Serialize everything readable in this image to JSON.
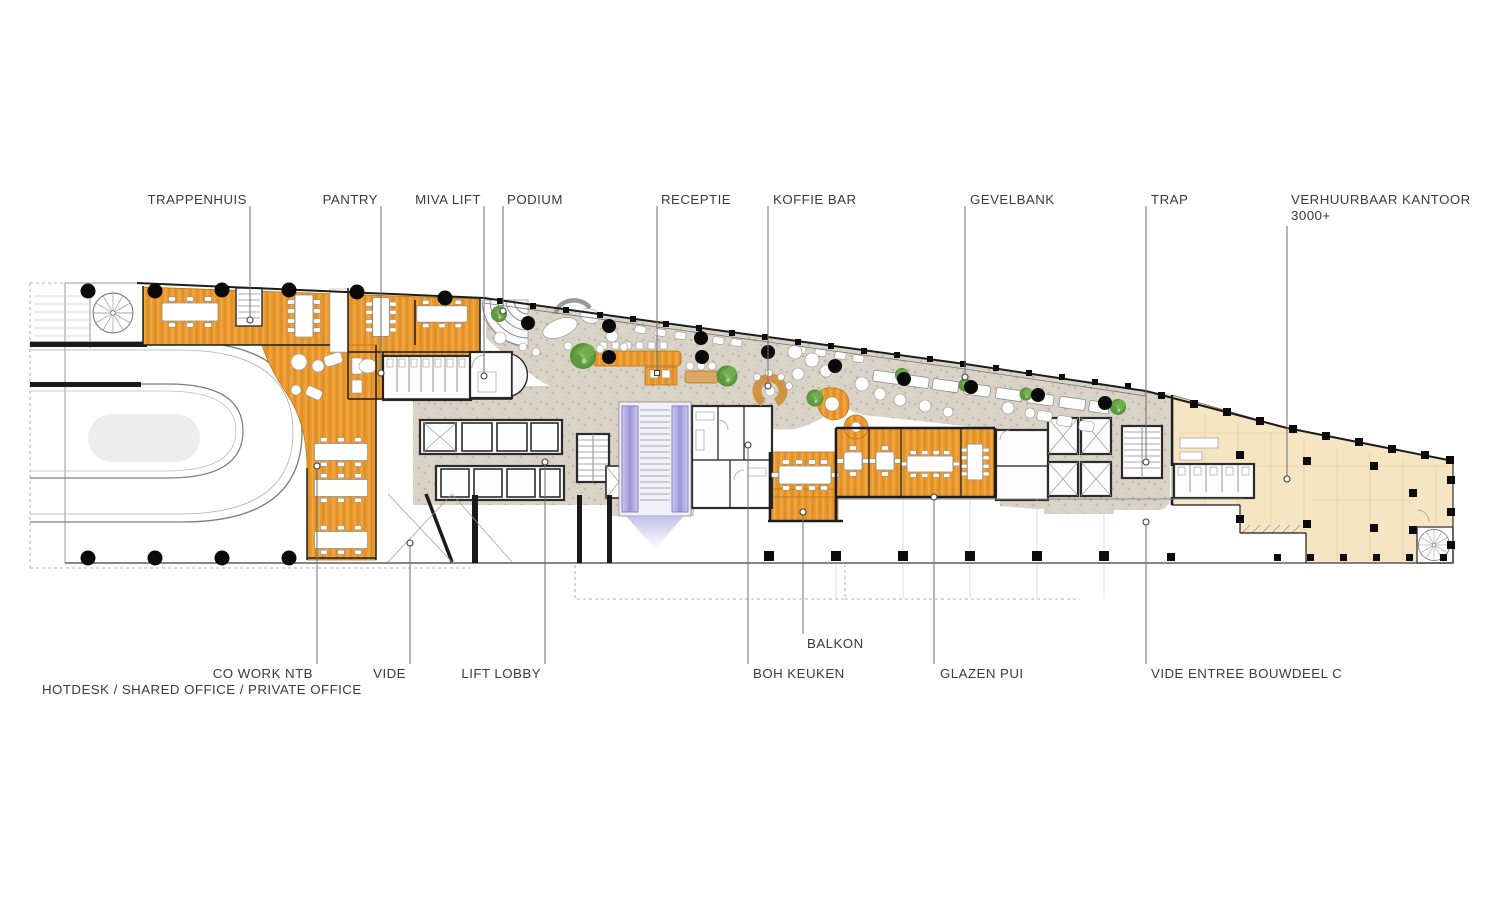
{
  "labels": {
    "trappenhuis": "TRAPPENHUIS",
    "pantry": "PANTRY",
    "miva_lift": "MIVA LIFT",
    "podium": "PODIUM",
    "receptie": "RECEPTIE",
    "koffie_bar": "KOFFIE BAR",
    "gevelbank": "GEVELBANK",
    "trap": "TRAP",
    "verhuurbaar_kantoor": "VERHUURBAAR KANTOOR",
    "verhuurbaar_kantoor_size": "3000+",
    "co_work_ntb": "CO WORK NTB",
    "co_work_sub": "HOTDESK / SHARED OFFICE / PRIVATE OFFICE",
    "vide": "VIDE",
    "lift_lobby": "LIFT LOBBY",
    "boh_keuken": "BOH KEUKEN",
    "balkon": "BALKON",
    "glazen_pui": "GLAZEN PUI",
    "vide_entree_bouwdeel_c": "VIDE ENTREE BOUWDEEL C"
  },
  "colors": {
    "wood": "#e8982e",
    "concrete": "#d9d2c6",
    "rentable": "#f5e5c2",
    "escalator": "#b4aee4",
    "plant": "#5f9c3f",
    "wall": "#1c1c1c",
    "label": "#3b3b3b"
  }
}
